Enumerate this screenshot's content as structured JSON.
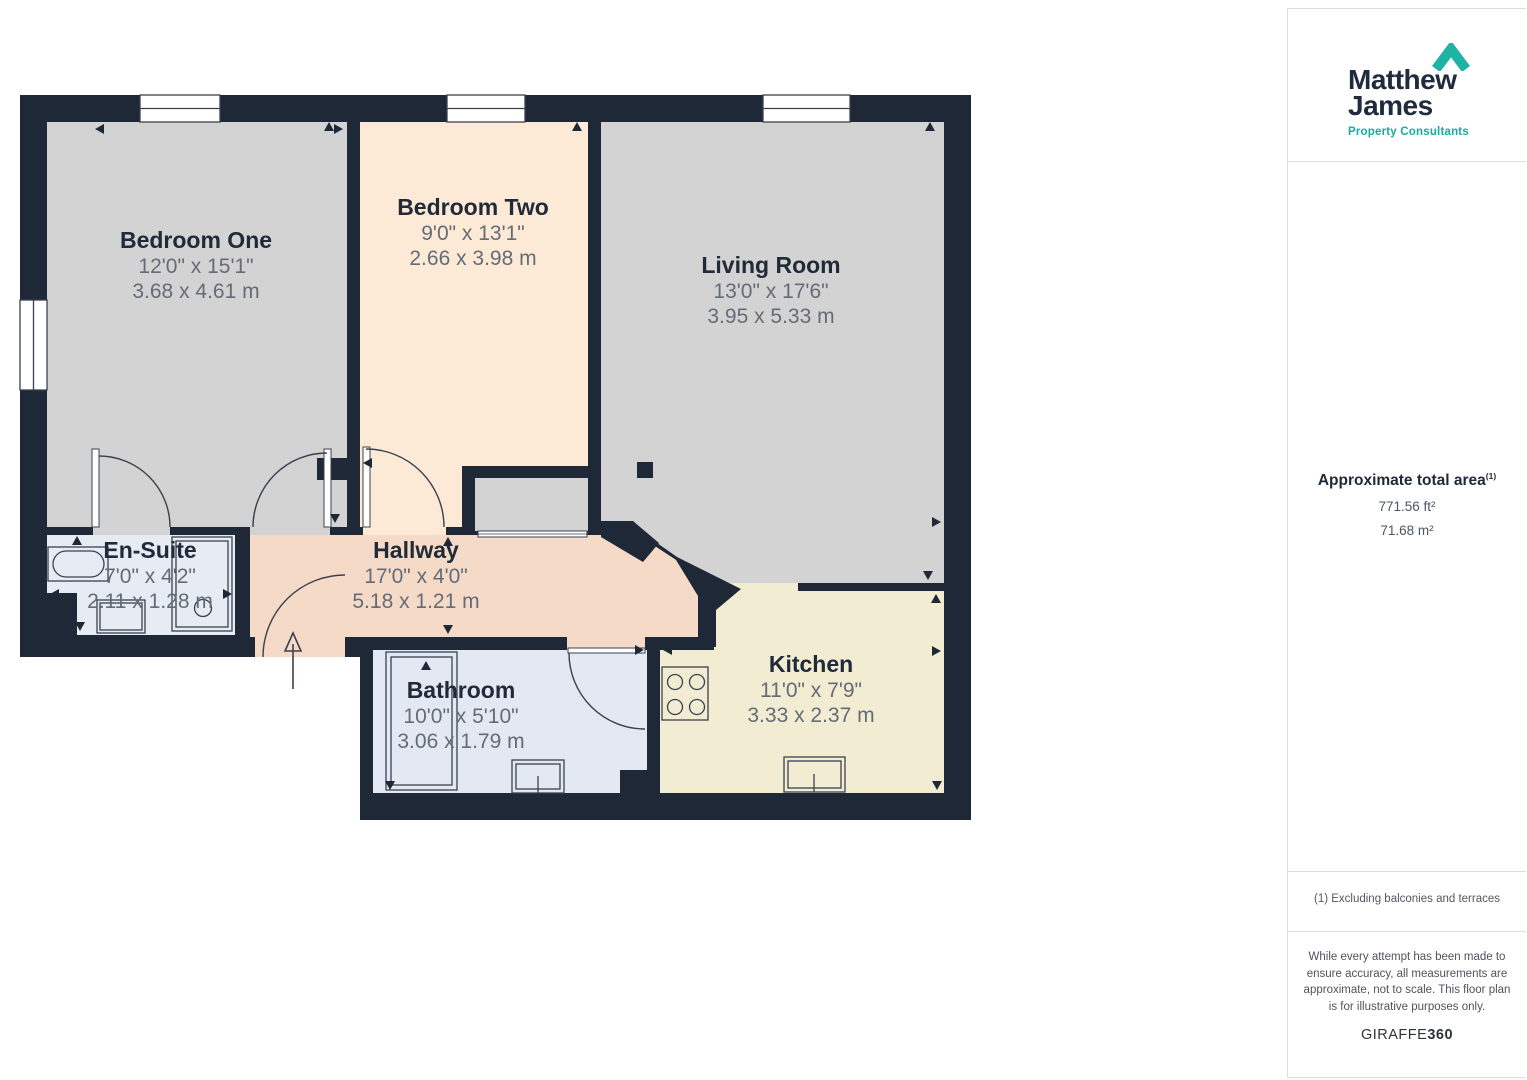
{
  "floorplan": {
    "rooms": [
      {
        "name": "Bedroom One",
        "imperial": "12'0\" x 15'1\"",
        "metric": "3.68 x 4.61 m"
      },
      {
        "name": "Bedroom Two",
        "imperial": "9'0\" x 13'1\"",
        "metric": "2.66 x 3.98 m"
      },
      {
        "name": "Living Room",
        "imperial": "13'0\" x 17'6\"",
        "metric": "3.95 x 5.33 m"
      },
      {
        "name": "En-Suite",
        "imperial": "7'0\" x 4'2\"",
        "metric": "2.11 x 1.28 m"
      },
      {
        "name": "Hallway",
        "imperial": "17'0\" x 4'0\"",
        "metric": "5.18 x 1.21 m"
      },
      {
        "name": "Bathroom",
        "imperial": "10'0\" x 5'10\"",
        "metric": "3.06 x 1.79 m"
      },
      {
        "name": "Kitchen",
        "imperial": "11'0\" x 7'9\"",
        "metric": "3.33 x 2.37 m"
      }
    ],
    "colors": {
      "wall": "#1e2836",
      "room_gray": "#d3d3d4",
      "room_peach": "#fcead7",
      "room_pink": "#f6dac8",
      "room_bluegray": "#e7ebf3",
      "room_cream": "#f2ecd3",
      "accent_teal": "#1fb3a6"
    }
  },
  "sidebar": {
    "logo": {
      "line1": "Matthew",
      "line2": "James",
      "subtitle": "Property Consultants"
    },
    "area": {
      "title": "Approximate total area",
      "footnote_marker": "(1)",
      "value_ft": "771.56 ft²",
      "value_m": "71.68 m²"
    },
    "footnote": "(1) Excluding balconies and terraces",
    "disclaimer": "While every attempt has been made to ensure accuracy, all measurements are approximate, not to scale. This floor plan is for illustrative purposes only.",
    "brand": {
      "normal": "GIRAFFE",
      "bold": "360"
    }
  }
}
